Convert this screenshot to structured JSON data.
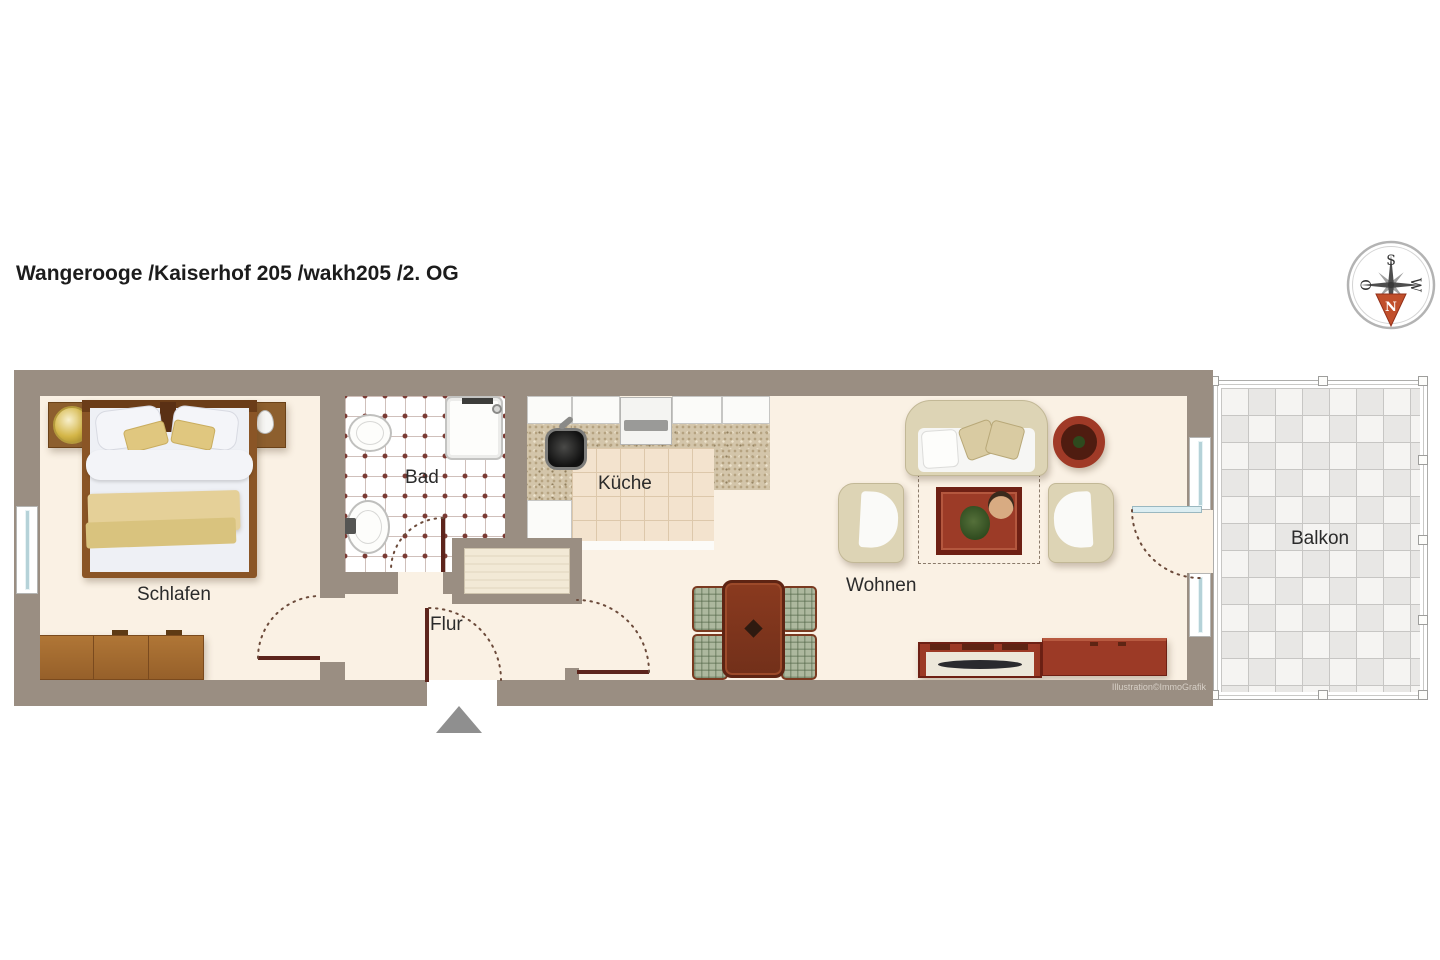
{
  "title": "Wangerooge /Kaiserhof 205 /wakh205 /2. OG",
  "compass": {
    "s": "S",
    "w": "W",
    "o": "O",
    "n": "N"
  },
  "rooms": {
    "bedroom": "Schlafen",
    "bathroom": "Bad",
    "kitchen": "Küche",
    "hallway": "Flur",
    "living": "Wohnen",
    "balcony": "Balkon"
  },
  "credit": "Illustration©ImmoGrafik",
  "colors": {
    "wall": "#9a8e82",
    "floor": "#faf1e4",
    "bath_dot": "#7a3a33",
    "kitchen_tile": "#f3e3ce",
    "balcony_light": "#f5f4f2",
    "balcony_dark": "#e8e7e5",
    "wood": "#8a5526",
    "mahogany": "#9c3a26",
    "upholstery": "#ddd4b5",
    "linen": "#eef0f5",
    "blanket": "#e5d098",
    "door": "#5d241c",
    "glass": "#dceef2",
    "compass_arrow": "#c8502e",
    "entry_arrow": "#8f8f8f",
    "text": "#1c1c1c",
    "credit": "#d6cfc6"
  }
}
